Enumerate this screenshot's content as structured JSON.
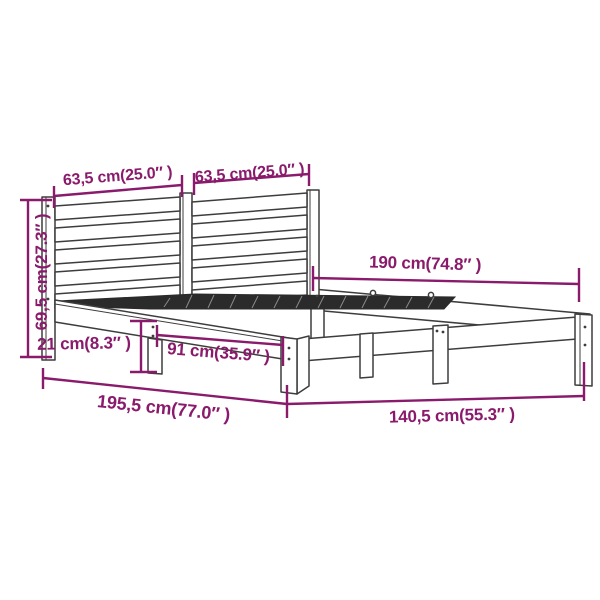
{
  "image": {
    "type": "product-dimension-diagram",
    "subject": "wooden bed frame with slatted headboard",
    "background": "#ffffff"
  },
  "colors": {
    "dimension_accent": "#8A1A6B",
    "outline": "#3d3d3d",
    "slats_dark": "#2b2b2b"
  },
  "dimensions": {
    "headboard_section_left": "63,5 cm(25.0″ )",
    "headboard_section_right": "63,5 cm(25.0″ )",
    "inner_length": "190 cm(74.8″ )",
    "headboard_height": "69,5 cm(27.3″ )",
    "under_bed_clearance": "21 cm(8.3″ )",
    "leg_spacing": "91 cm(35.9″ )",
    "overall_length": "195,5 cm(77.0″ )",
    "overall_width": "140,5 cm(55.3″ )"
  }
}
